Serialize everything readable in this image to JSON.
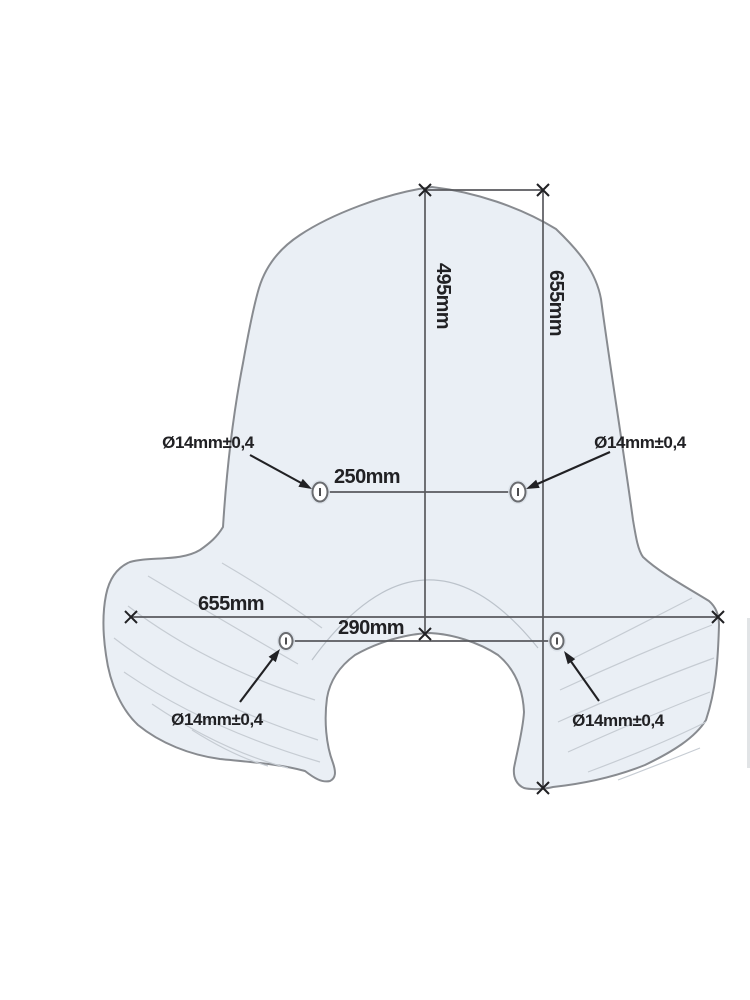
{
  "dims": {
    "inner_height": "495mm",
    "total_height": "655mm",
    "upper_hole_spacing": "250mm",
    "total_width": "655mm",
    "lower_hole_spacing": "290mm"
  },
  "holes": {
    "upper_left_label": "Ø14mm±0,4",
    "upper_right_label": "Ø14mm±0,4",
    "lower_left_label": "Ø14mm±0,4",
    "lower_right_label": "Ø14mm±0,4"
  },
  "colors": {
    "background": "#ffffff",
    "screen_fill": "#eaeff5",
    "screen_outline": "#888b90",
    "dimension_line": "#595a5e",
    "annotation_ink": "#212124",
    "hatch_line": "#c6ccd3"
  }
}
